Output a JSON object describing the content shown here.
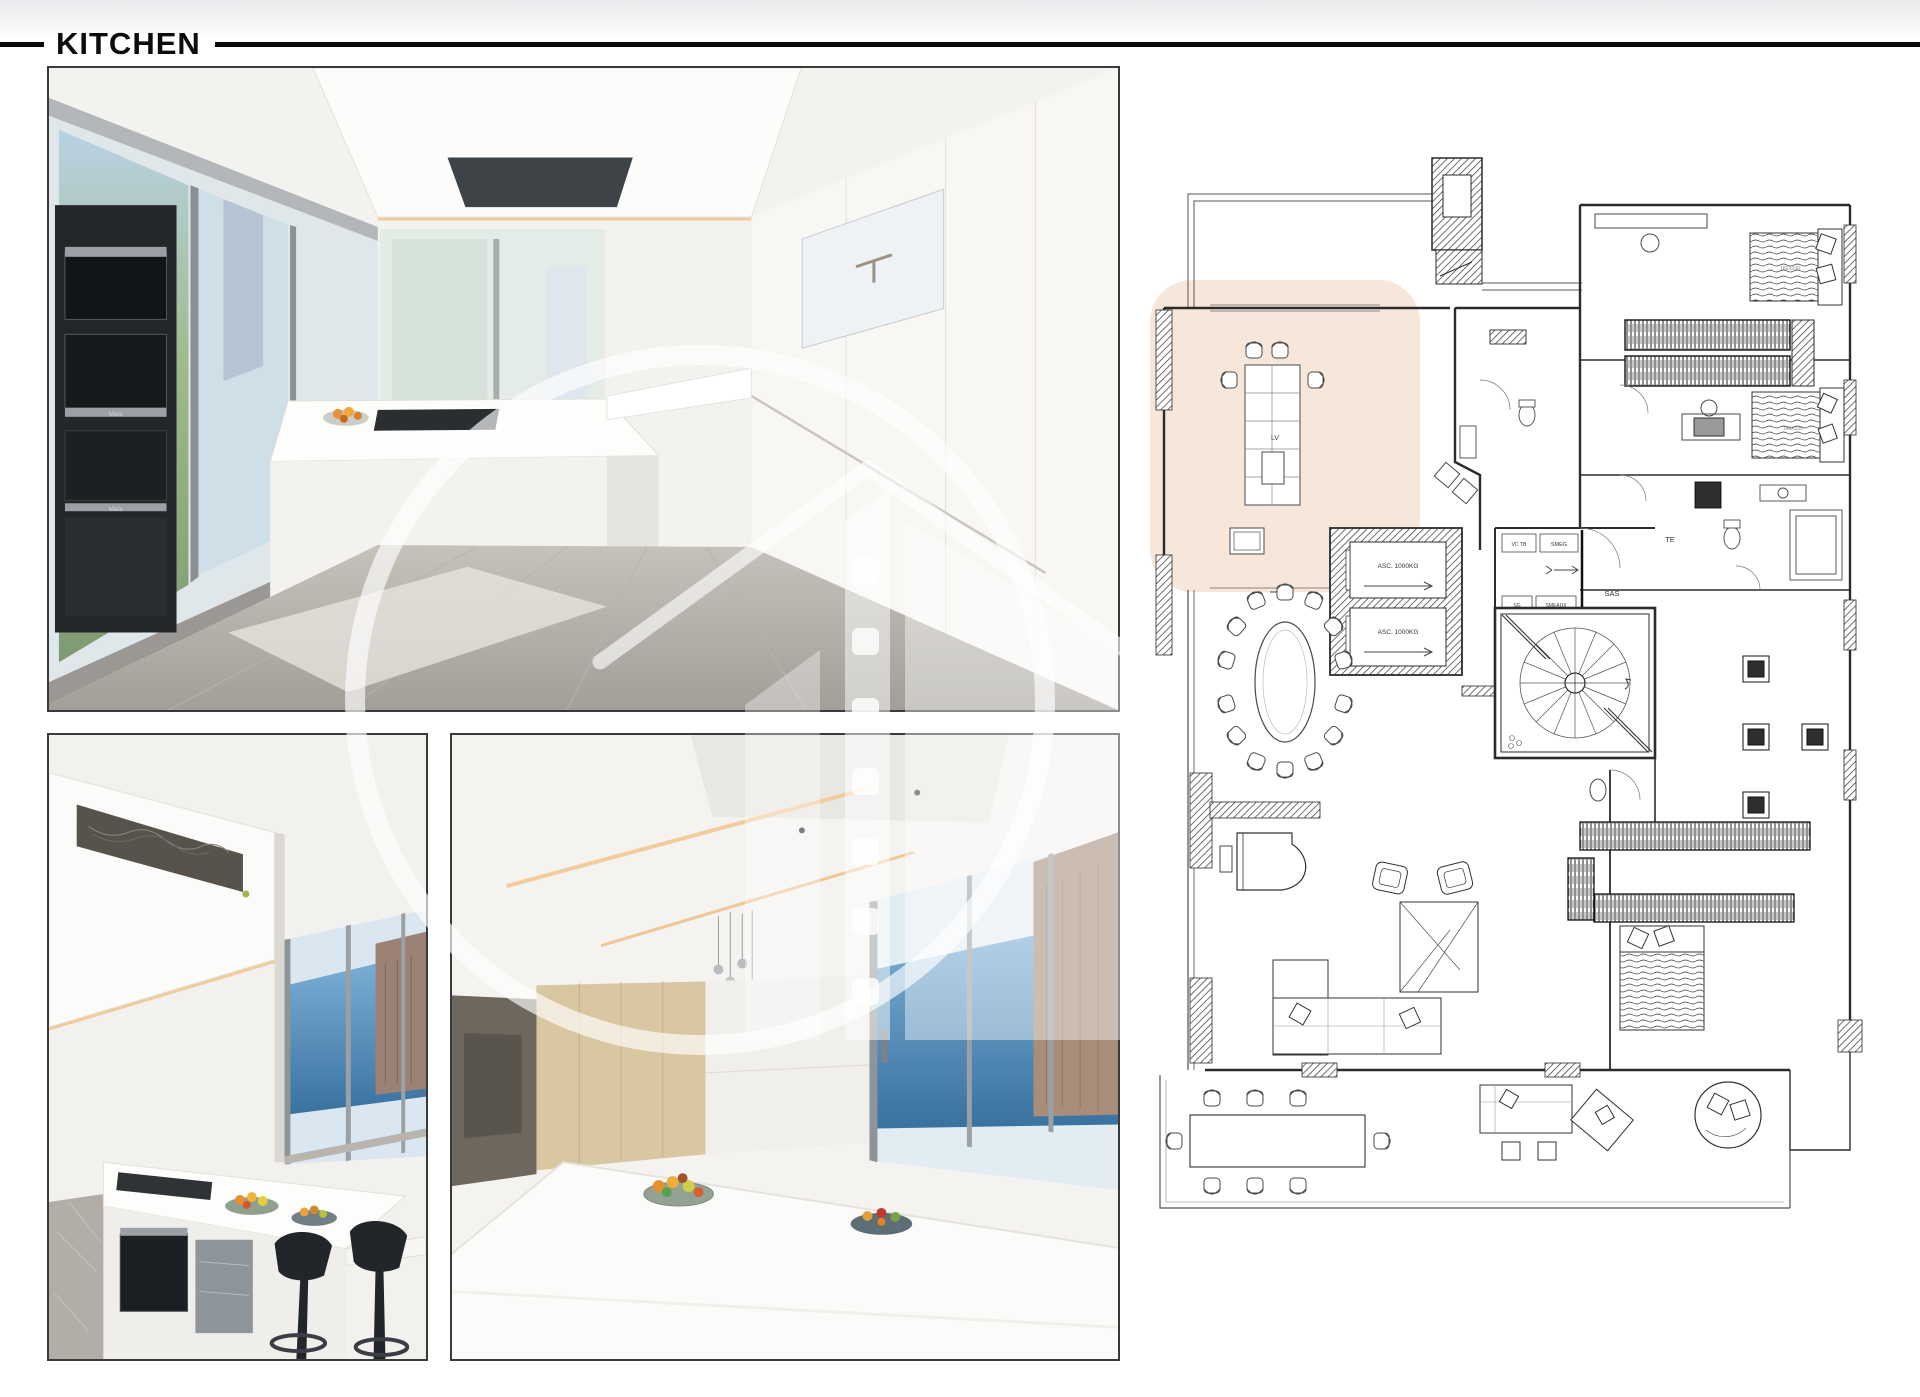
{
  "header": {
    "title": "KITCHEN"
  },
  "plan": {
    "labels": {
      "elevator_top": "ASC. 1000KG",
      "elevator_bottom": "ASC. 1000KG",
      "dishwasher": "LV",
      "sas": "SAS",
      "smeg": "SMEG",
      "vc_tb": "VC TB",
      "sg": "SG",
      "smeaux": "SMEAUX",
      "te": "TE",
      "bed_top_size": "160X200",
      "bed_middle_size": "160X200"
    },
    "highlight_color": "#f2d8c5",
    "line_color": "#2b2b2b"
  },
  "photos": {
    "main": {
      "brand1": "Miele",
      "brand2": "Miele"
    }
  },
  "colors": {
    "sea": "#4179a8",
    "sky": "#dde9f2",
    "wood": "#d9c7a2",
    "led_warm": "#f0cb9c",
    "fruit_orange": "#ec9a33",
    "stool_black": "#24272c",
    "floor_gray": "#aeaaa3",
    "photo_border": "#3a3a3a",
    "rule_black": "#0a0a0a"
  }
}
